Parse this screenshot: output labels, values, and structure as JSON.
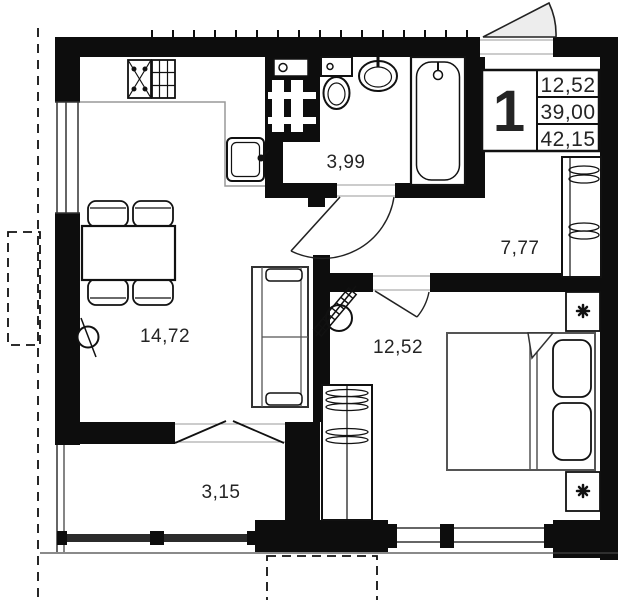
{
  "unit_card": {
    "number": "1",
    "values": [
      "12,52",
      "39,00",
      "42,15"
    ]
  },
  "rooms": [
    {
      "id": "bathroom",
      "area_label": "3,99"
    },
    {
      "id": "hallway",
      "area_label": "7,77"
    },
    {
      "id": "living-kitchen",
      "area_label": "14,72"
    },
    {
      "id": "bedroom",
      "area_label": "12,52"
    },
    {
      "id": "balcony",
      "area_label": "3,15"
    }
  ],
  "colors": {
    "wall": "#0d0d0d",
    "thin_line": "#555555",
    "door_fill": "#ededed",
    "glazing": "#2b2b2b",
    "background": "#ffffff"
  }
}
